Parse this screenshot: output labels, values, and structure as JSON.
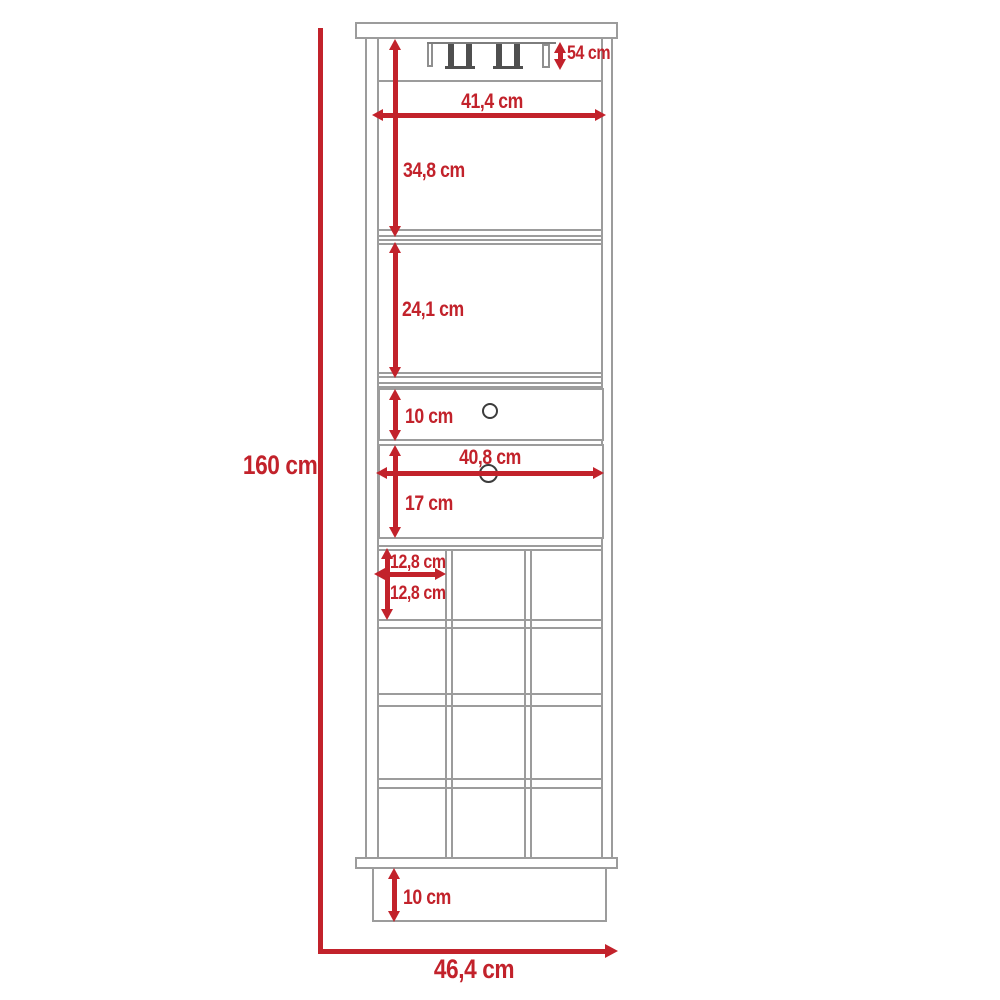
{
  "diagram": {
    "title": "Bar cabinet dimension drawing",
    "unit": "cm",
    "accent_color": "#C2222B",
    "line_color": "#9c9c9c",
    "labels": {
      "total_height": "160 cm",
      "total_width": "46,4 cm",
      "glass_rack_height": "54 cm",
      "inner_width": "41,4 cm",
      "upper_section_height": "34,8 cm",
      "middle_section_height": "24,1 cm",
      "top_drawer_height": "10 cm",
      "bottom_drawer_width": "40,8 cm",
      "bottom_drawer_height": "17 cm",
      "wine_cell_width": "12,8 cm",
      "wine_cell_height": "12,8 cm",
      "base_height": "10 cm"
    }
  }
}
